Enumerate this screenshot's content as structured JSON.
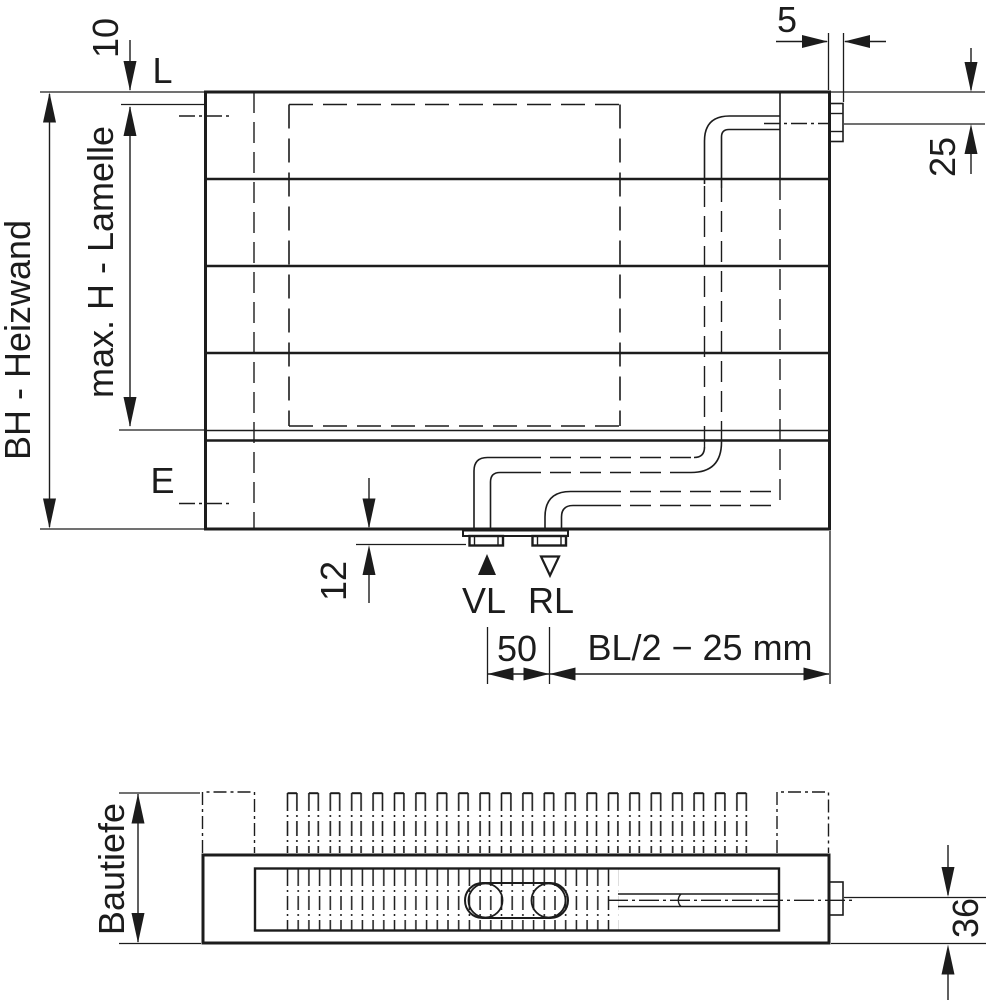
{
  "drawing": {
    "front_view": {
      "dim_lamelle_top_offset": "10",
      "label_lamelle_top_line": "L",
      "dim_build_height": "BH - Heizwand",
      "dim_max_lamelle_height": "max. H - Lamelle",
      "label_connection_line": "E",
      "dim_vent_protrusion": "5",
      "dim_vent_axis_offset": "25",
      "dim_stub_protrusion": "12",
      "label_supply": "VL",
      "label_return": "RL",
      "dim_stub_spacing": "50",
      "dim_stub_position": "BL/2 − 25 mm"
    },
    "plan_view": {
      "dim_build_depth": "Bautiefe",
      "dim_pipe_axis_offset": "36"
    }
  },
  "colors": {
    "line": "#1c1c1c",
    "background": "#ffffff"
  }
}
